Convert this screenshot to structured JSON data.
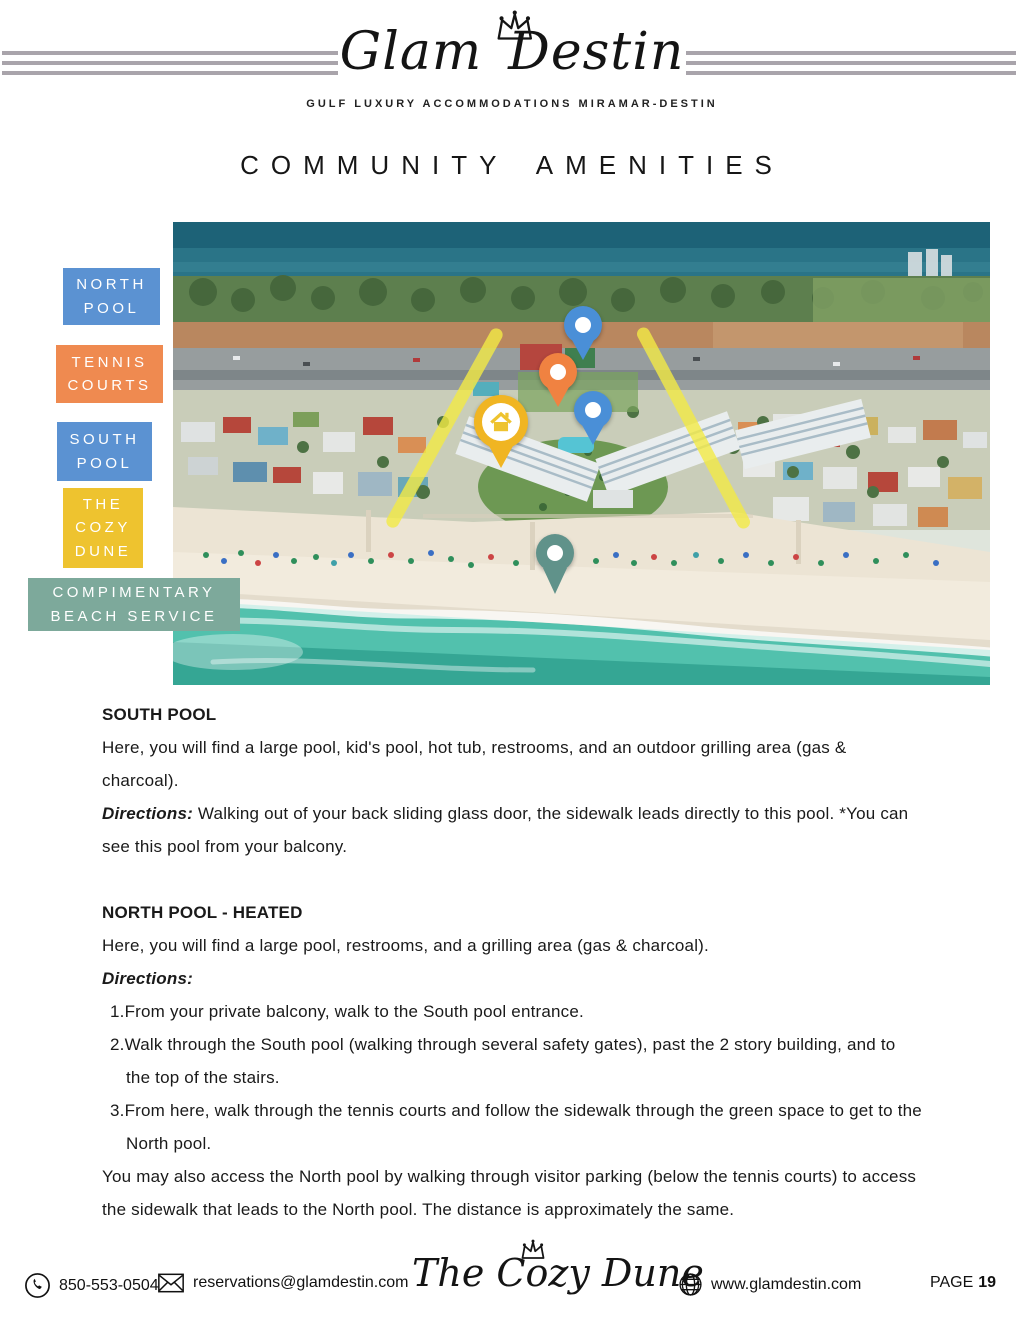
{
  "header": {
    "brand_word1": "Glam",
    "brand_word2": "Destin",
    "tagline": "GULF LUXURY ACCOMMODATIONS MIRAMAR-DESTIN"
  },
  "title": "COMMUNITY AMENITIES",
  "map": {
    "legend": [
      {
        "label": "NORTH POOL",
        "color": "#5b92d2"
      },
      {
        "label": "TENNIS COURTS",
        "color": "#ef8a50"
      },
      {
        "label": "SOUTH POOL",
        "color": "#5b92d2"
      },
      {
        "label": "THE COZY DUNE",
        "color": "#eec32f"
      },
      {
        "label": "COMPIMENTARY BEACH SERVICE",
        "color": "#7da99b"
      }
    ],
    "pins": [
      {
        "name": "north-pool-pin",
        "color": "#4a8fd7"
      },
      {
        "name": "tennis-courts-pin",
        "color": "#f08241"
      },
      {
        "name": "south-pool-pin",
        "color": "#4a8fd7"
      },
      {
        "name": "cozy-dune-house-pin",
        "color": "#f0b522",
        "icon": "house-icon"
      },
      {
        "name": "beach-service-pin",
        "color": "#60928a"
      }
    ],
    "route_highlight_color": "#f2ea45"
  },
  "sections": [
    {
      "heading": "SOUTH POOL",
      "intro": "Here, you will find a large pool, kid's pool, hot tub, restrooms, and an outdoor grilling area (gas & charcoal).",
      "directions_label": "Directions:",
      "directions_text": " Walking out of your back sliding glass door, the sidewalk leads directly to this pool. *You can see this pool from your balcony."
    },
    {
      "heading": "NORTH POOL - HEATED",
      "intro": "Here, you will find a large pool, restrooms, and a grilling area (gas & charcoal).",
      "directions_label": "Directions:",
      "steps": [
        {
          "num": "1.",
          "text": "From your private balcony, walk to the South pool entrance."
        },
        {
          "num": "2.",
          "text": "Walk through the South pool (walking through several safety gates), past the 2 story building, and to the top of the stairs."
        },
        {
          "num": "3.",
          "text": "From here, walk through the tennis courts and follow the sidewalk through the green space to get to the North pool."
        }
      ],
      "outro": "You may also access the North pool by walking through visitor parking (below the tennis courts) to access the sidewalk that leads to the North pool. The distance is approximately the same."
    }
  ],
  "footer": {
    "phone": "850-553-0504",
    "email": "reservations@glamdestin.com",
    "logo_script": "The Cozy Dune",
    "website": "www.glamdestin.com",
    "page_label": "PAGE",
    "page_number": "19"
  }
}
